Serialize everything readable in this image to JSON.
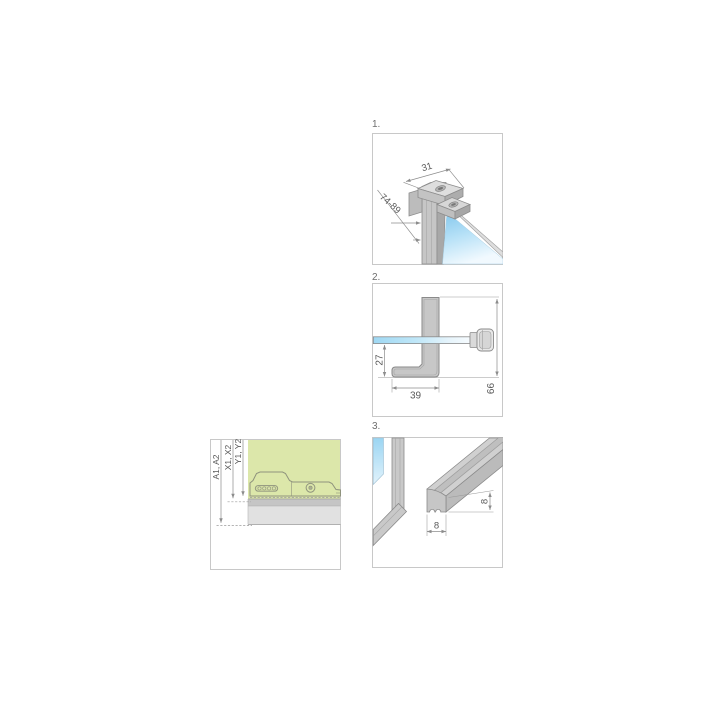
{
  "page": {
    "background": "#ffffff"
  },
  "colors": {
    "box_border": "#c8c8c8",
    "metal_gray": "#c7c7c7",
    "metal_shade": "#a9a9a9",
    "glass_blue": "#8fccee",
    "panel_green": "#dce7aa",
    "rail_gray": "#e1e1e1",
    "dim_line": "#8c8c8c",
    "dim_text": "#5a5a5a"
  },
  "figures": {
    "step1": {
      "number": "1.",
      "dims": {
        "profile_width": "31",
        "adjust_range": "74-89"
      }
    },
    "step2": {
      "number": "2.",
      "dims": {
        "glass_to_foot": "27",
        "foot_depth": "39",
        "overall_height": "66"
      }
    },
    "step3": {
      "number": "3.",
      "dims": {
        "seal_height": "8",
        "seal_width": "8"
      }
    },
    "adjustment": {
      "dims": {
        "row_a": "A1, A2",
        "row_x": "X1, X2",
        "row_y": "Y1, Y2"
      }
    }
  }
}
